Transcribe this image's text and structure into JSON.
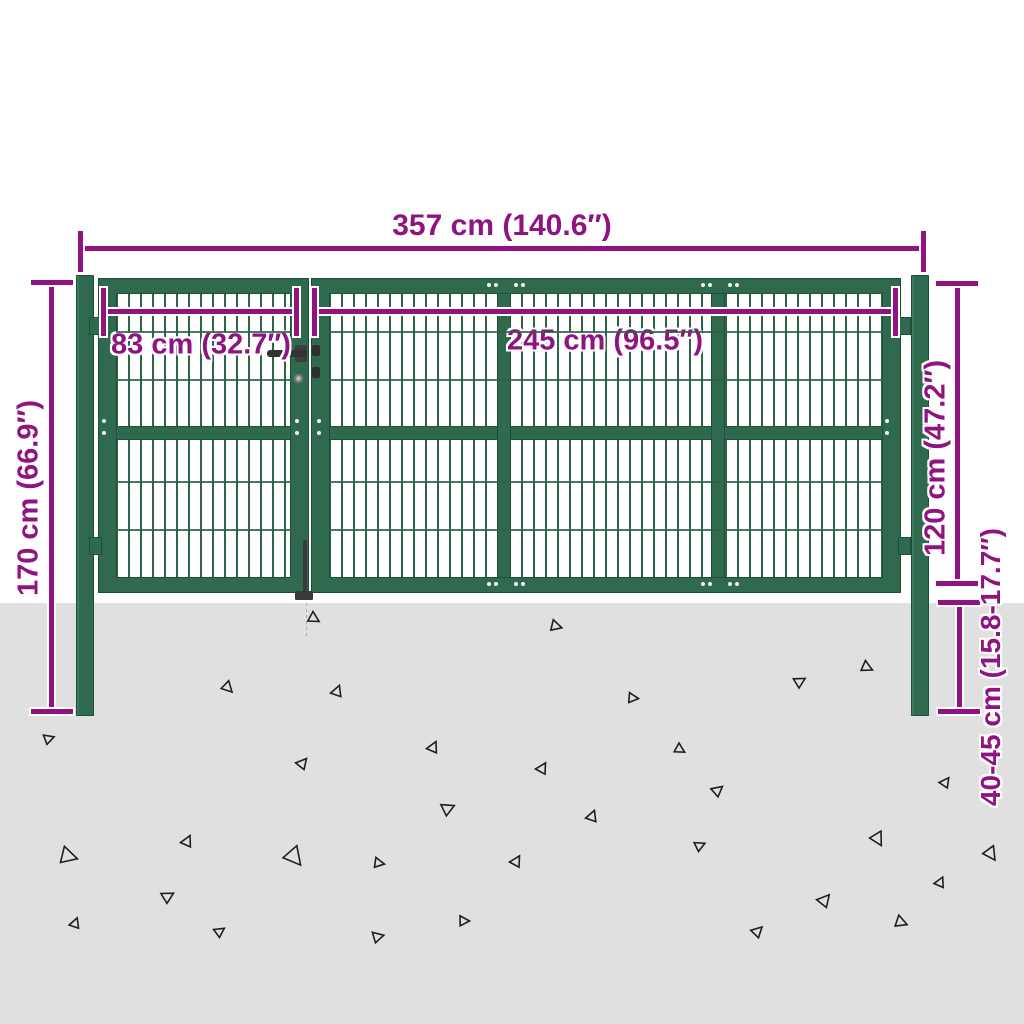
{
  "colors": {
    "gate_green": "#2f6a4f",
    "gate_green_dark": "#1d5038",
    "mesh_green": "#2c6349",
    "dimension_magenta": "#8f1380",
    "ground_gray": "#e0e0e0",
    "triangle_outline": "#1f1f1f"
  },
  "dimensions": {
    "total_width": "357 cm (140.6″)",
    "small_gate_width": "83 cm (32.7″)",
    "large_gate_width": "245 cm (96.5″)",
    "post_height": "170 cm (66.9″)",
    "gate_panel_height": "120 cm (47.2″)",
    "underground_depth": "40-45 cm (15.8-17.7″)"
  },
  "scene": {
    "triangles": [
      {
        "x": 313,
        "y": 618,
        "s": 13,
        "r": 0
      },
      {
        "x": 555,
        "y": 626,
        "s": 13,
        "r": 15
      },
      {
        "x": 227,
        "y": 687,
        "s": 13,
        "r": -15
      },
      {
        "x": 337,
        "y": 692,
        "s": 13,
        "r": 100
      },
      {
        "x": 632,
        "y": 698,
        "s": 12,
        "r": 25
      },
      {
        "x": 799,
        "y": 682,
        "s": 13,
        "r": 60
      },
      {
        "x": 866,
        "y": 667,
        "s": 13,
        "r": 5
      },
      {
        "x": 48,
        "y": 739,
        "s": 12,
        "r": 50
      },
      {
        "x": 433,
        "y": 748,
        "s": 13,
        "r": 95
      },
      {
        "x": 302,
        "y": 764,
        "s": 13,
        "r": 80
      },
      {
        "x": 679,
        "y": 749,
        "s": 12,
        "r": 0
      },
      {
        "x": 542,
        "y": 769,
        "s": 13,
        "r": 90
      },
      {
        "x": 717,
        "y": 791,
        "s": 13,
        "r": 70
      },
      {
        "x": 945,
        "y": 783,
        "s": 12,
        "r": 85
      },
      {
        "x": 447,
        "y": 809,
        "s": 15,
        "r": 55
      },
      {
        "x": 67,
        "y": 856,
        "s": 20,
        "r": 15
      },
      {
        "x": 187,
        "y": 842,
        "s": 13,
        "r": 95
      },
      {
        "x": 293,
        "y": 856,
        "s": 22,
        "r": -20
      },
      {
        "x": 592,
        "y": 817,
        "s": 13,
        "r": 100
      },
      {
        "x": 699,
        "y": 846,
        "s": 12,
        "r": 55
      },
      {
        "x": 877,
        "y": 838,
        "s": 16,
        "r": -30
      },
      {
        "x": 167,
        "y": 897,
        "s": 14,
        "r": 60
      },
      {
        "x": 990,
        "y": 853,
        "s": 16,
        "r": -25
      },
      {
        "x": 824,
        "y": 901,
        "s": 15,
        "r": 80
      },
      {
        "x": 900,
        "y": 922,
        "s": 14,
        "r": 10
      },
      {
        "x": 940,
        "y": 883,
        "s": 12,
        "r": 95
      },
      {
        "x": 75,
        "y": 924,
        "s": 12,
        "r": 100
      },
      {
        "x": 377,
        "y": 937,
        "s": 13,
        "r": 45
      },
      {
        "x": 516,
        "y": 862,
        "s": 13,
        "r": 90
      },
      {
        "x": 378,
        "y": 863,
        "s": 12,
        "r": 20
      },
      {
        "x": 757,
        "y": 932,
        "s": 13,
        "r": 75
      },
      {
        "x": 463,
        "y": 921,
        "s": 12,
        "r": 30
      },
      {
        "x": 219,
        "y": 932,
        "s": 12,
        "r": 65
      }
    ]
  }
}
